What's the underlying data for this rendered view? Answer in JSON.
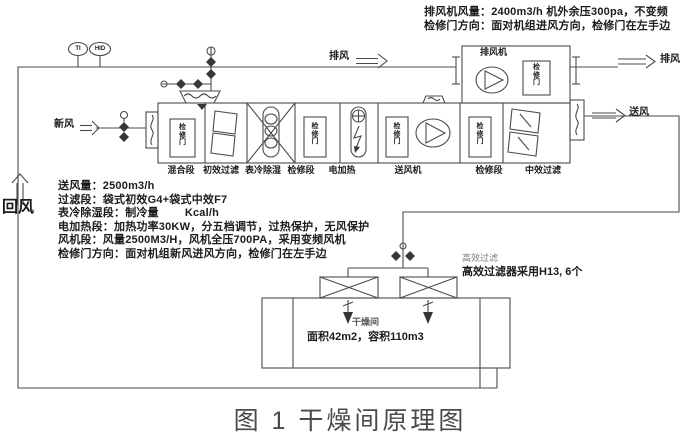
{
  "caption": "图 1 干燥间原理图",
  "top_note": {
    "line1": "排风机风量：2400m3/h 机外余压300pa，不变频",
    "line2": "检修门方向：面对机组进风方向，检修门在左手边"
  },
  "specs": {
    "line1": "送风量：2500m3/h",
    "line2": "过滤段：袋式初效G4+袋式中效F7",
    "line3": "表冷除湿段：制冷量        Kcal/h",
    "line4": "电加热段：加热功率30KW，分五档调节，过热保护，无风保护",
    "line5": "风机段：风量2500M3/H，风机全压700PA，采用变频风机",
    "line6": "检修门方向：面对机组新风进风方向，检修门在左手边"
  },
  "flows": {
    "fresh_air": "新风",
    "exhaust_top": "排风",
    "exhaust_right": "排风",
    "supply": "送风",
    "return_air": "回风"
  },
  "instruments": {
    "left": "TI",
    "right": "HID"
  },
  "ahu": {
    "sections": [
      "混合段",
      "初效过滤",
      "表冷除湿",
      "检修段",
      "电加热",
      "送风机",
      "检修段",
      "中效过滤"
    ],
    "door": "检修门"
  },
  "exhaust_unit": {
    "label": "排风机",
    "door": "检修门"
  },
  "hepa": {
    "note_small": "高效过滤",
    "note_bold": "高效过滤器采用H13, 6个"
  },
  "room": {
    "name": "干燥间",
    "size": "面积42m2，容积110m3"
  },
  "colors": {
    "line": "#4f4a45",
    "text": "#1c1c1c",
    "caption": "#4a4a4a"
  }
}
